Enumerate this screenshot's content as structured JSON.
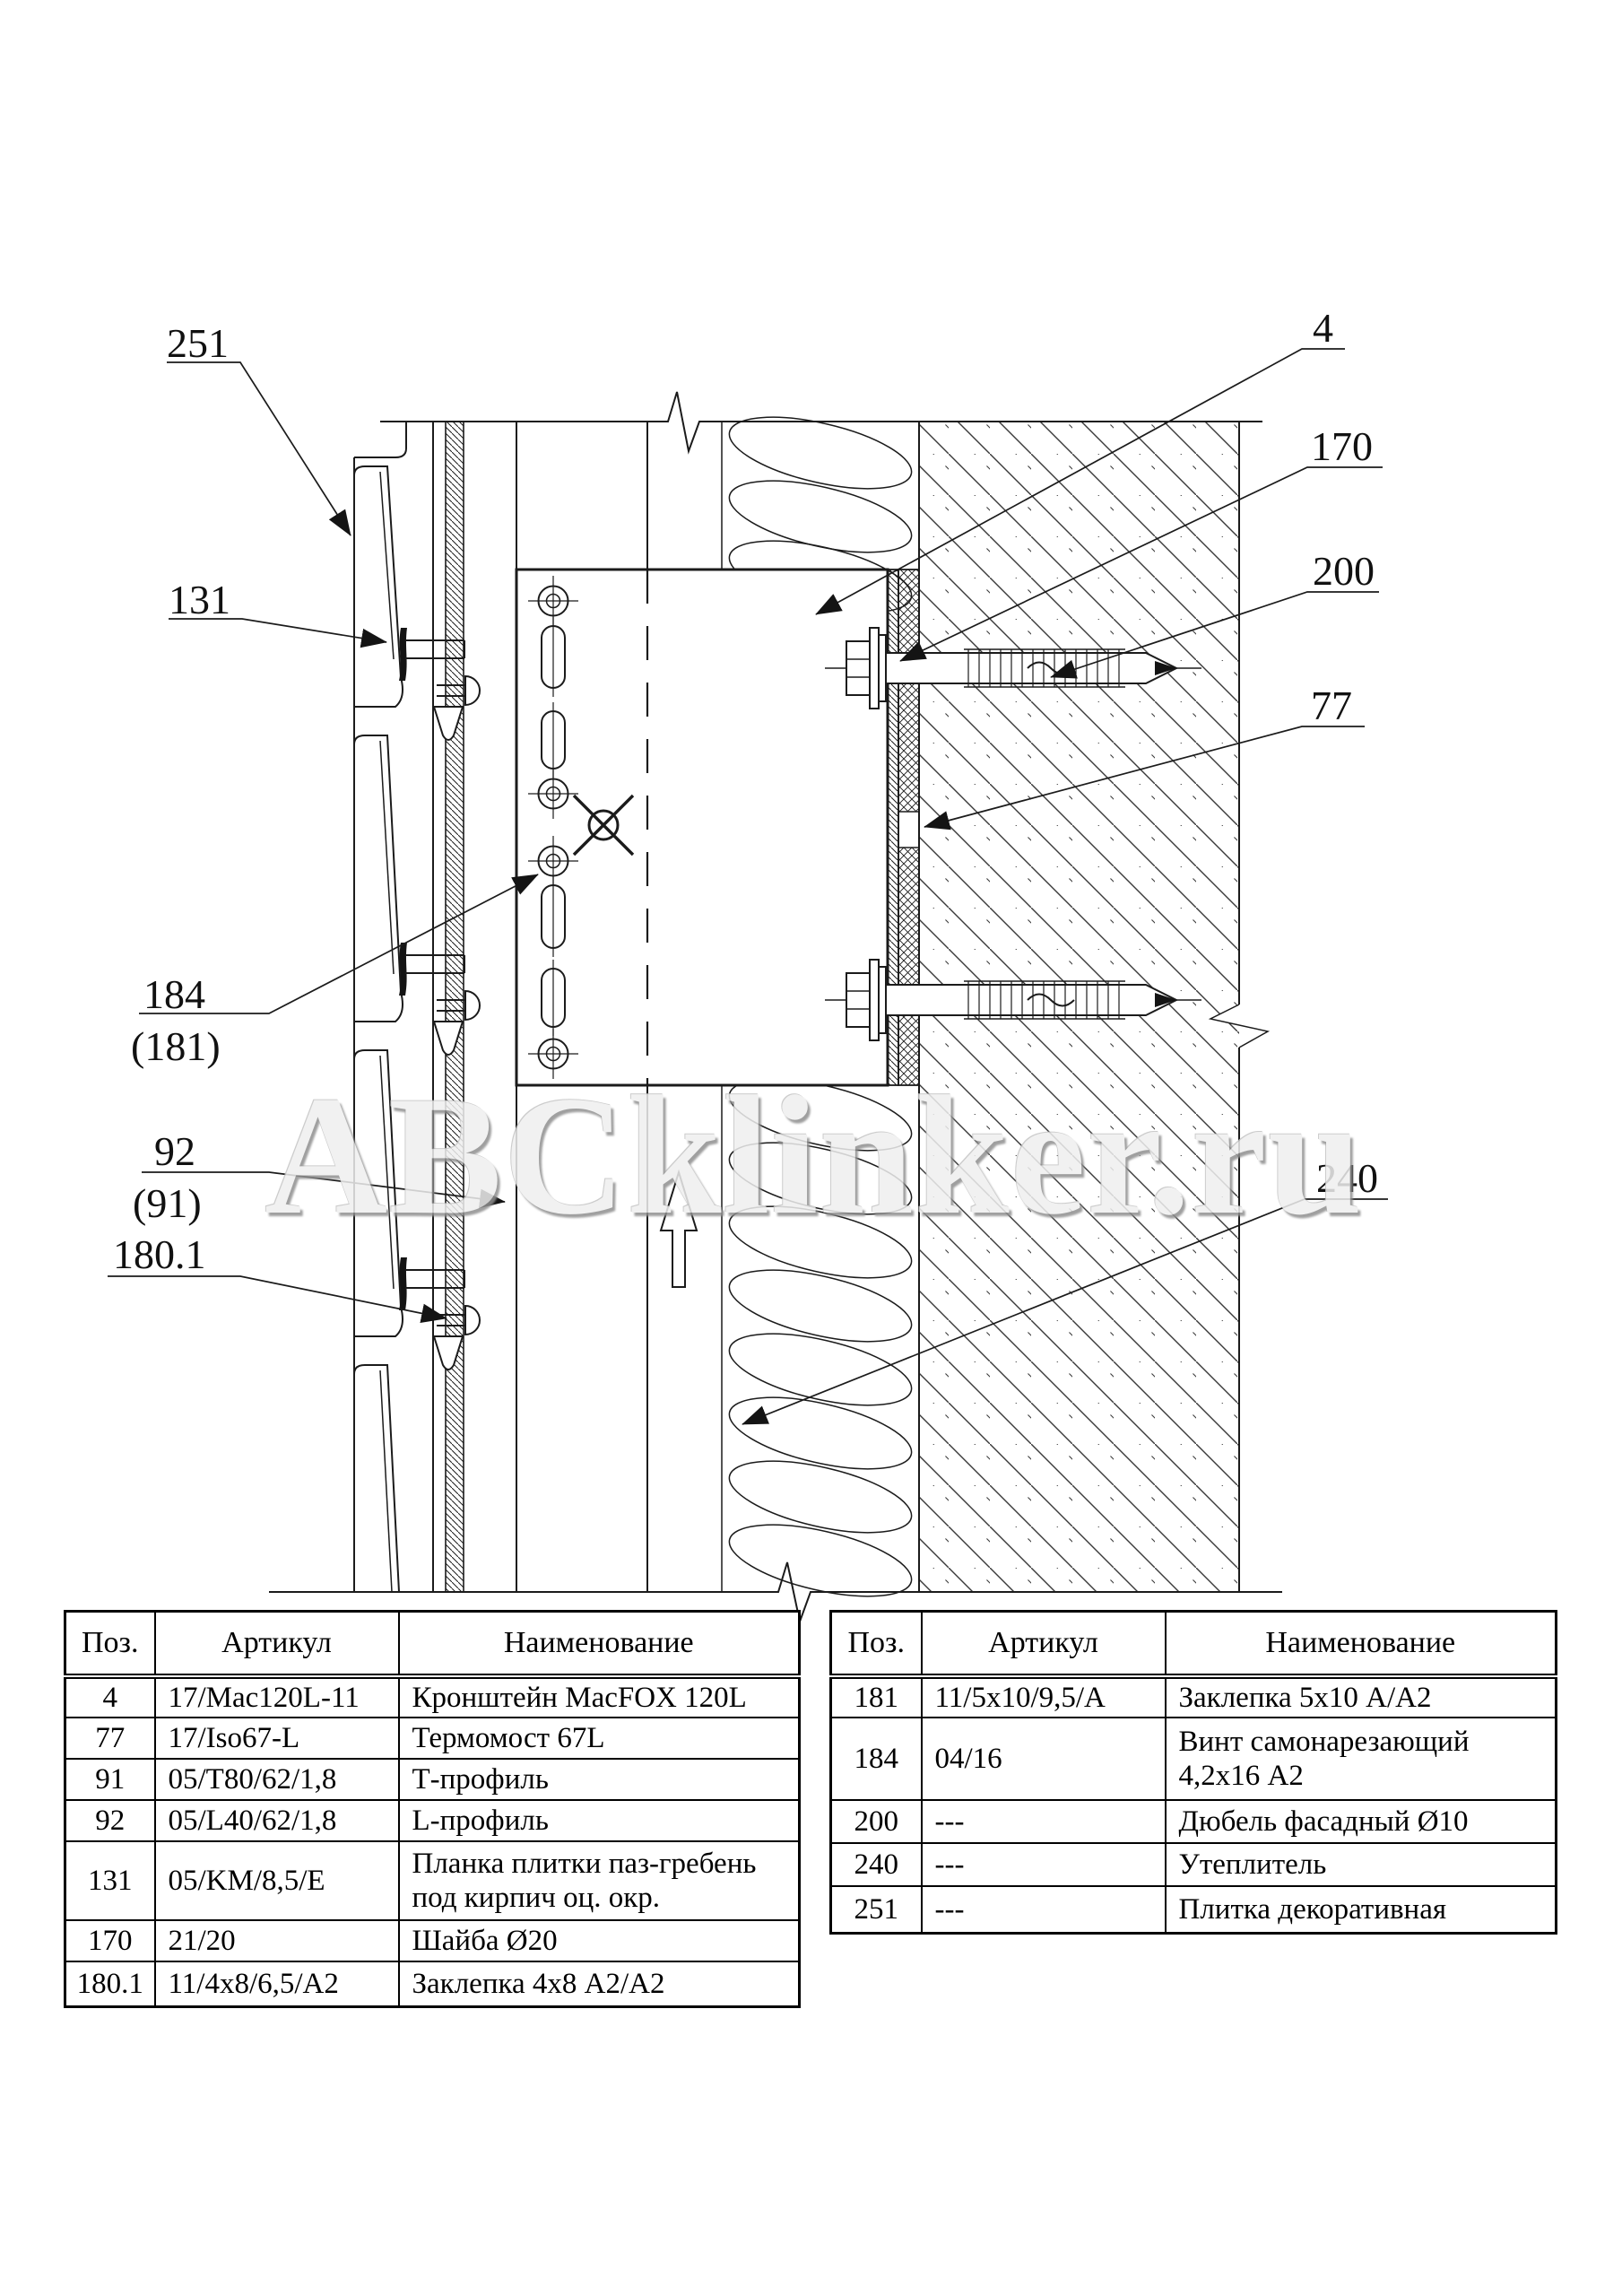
{
  "watermark": "ABCklinker.ru",
  "drawing": {
    "labels": {
      "l251": "251",
      "l131": "131",
      "l184": "184",
      "l181": "(181)",
      "l92": "92",
      "l91": "(91)",
      "l180_1": "180.1",
      "l4": "4",
      "l170": "170",
      "l200": "200",
      "l77": "77",
      "l240": "240"
    }
  },
  "tables": {
    "left": {
      "headers": [
        "Поз.",
        "Артикул",
        "Наименование"
      ],
      "rows": [
        {
          "pos": "4",
          "art": "17/Mac120L-11",
          "name": "Кронштейн MacFOX 120L"
        },
        {
          "pos": "77",
          "art": "17/Iso67-L",
          "name": "Термомост 67L"
        },
        {
          "pos": "91",
          "art": "05/T80/62/1,8",
          "name": "Т-профиль"
        },
        {
          "pos": "92",
          "art": "05/L40/62/1,8",
          "name": "L-профиль"
        },
        {
          "pos": "131",
          "art": "05/KM/8,5/E",
          "name": "Планка плитки паз-гребень под кирпич оц. окр."
        },
        {
          "pos": "170",
          "art": "21/20",
          "name": "Шайба Ø20"
        },
        {
          "pos": "180.1",
          "art": "11/4x8/6,5/A2",
          "name": "Заклепка 4x8 А2/А2"
        }
      ]
    },
    "right": {
      "headers": [
        "Поз.",
        "Артикул",
        "Наименование"
      ],
      "rows": [
        {
          "pos": "181",
          "art": "11/5x10/9,5/A",
          "name": "Заклепка 5x10 А/А2"
        },
        {
          "pos": "184",
          "art": "04/16",
          "name": "Винт самонарезающий 4,2x16 А2"
        },
        {
          "pos": "200",
          "art": "---",
          "name": "Дюбель фасадный Ø10"
        },
        {
          "pos": "240",
          "art": "---",
          "name": "Утеплитель"
        },
        {
          "pos": "251",
          "art": "---",
          "name": "Плитка декоративная"
        }
      ]
    }
  }
}
